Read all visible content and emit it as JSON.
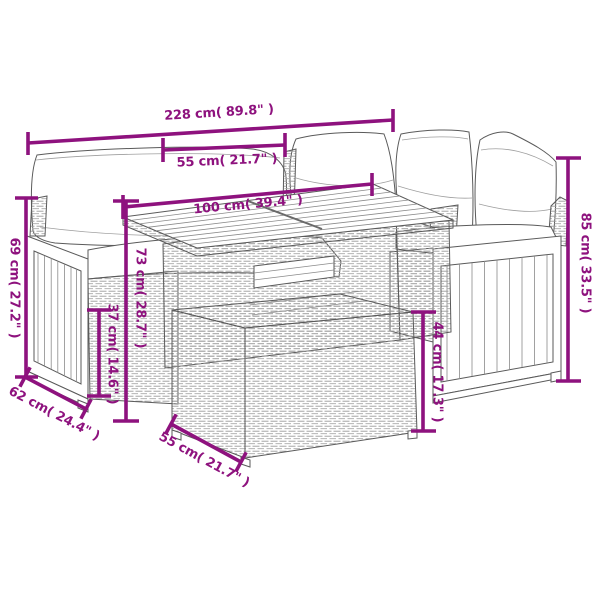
{
  "diagram": {
    "subject": "rattan-garden-corner-sofa-set-with-two-slat-top-tables-dimension-drawing",
    "dimensions": [
      {
        "id": "total-width",
        "label": "228 cm( 89.8\" )"
      },
      {
        "id": "table-top-width",
        "label": "55 cm( 21.7\" )"
      },
      {
        "id": "table-length",
        "label": "100 cm( 39.4\" )"
      },
      {
        "id": "total-height",
        "label": "85 cm( 33.5\" )"
      },
      {
        "id": "left-arm-height",
        "label": "69 cm( 27.2\" )"
      },
      {
        "id": "table-height",
        "label": "73 cm( 28.7\" )"
      },
      {
        "id": "seat-base-height",
        "label": "37 cm( 14.6\" )"
      },
      {
        "id": "side-table-height",
        "label": "44 cm( 17.3\" )"
      },
      {
        "id": "seat-depth",
        "label": "62 cm( 24.4\" )"
      },
      {
        "id": "side-table-width",
        "label": "55 cm( 21.7\" )"
      }
    ]
  },
  "colors": {
    "dimension_accent": "#8E127E",
    "line_art": "#5A5A5A"
  }
}
